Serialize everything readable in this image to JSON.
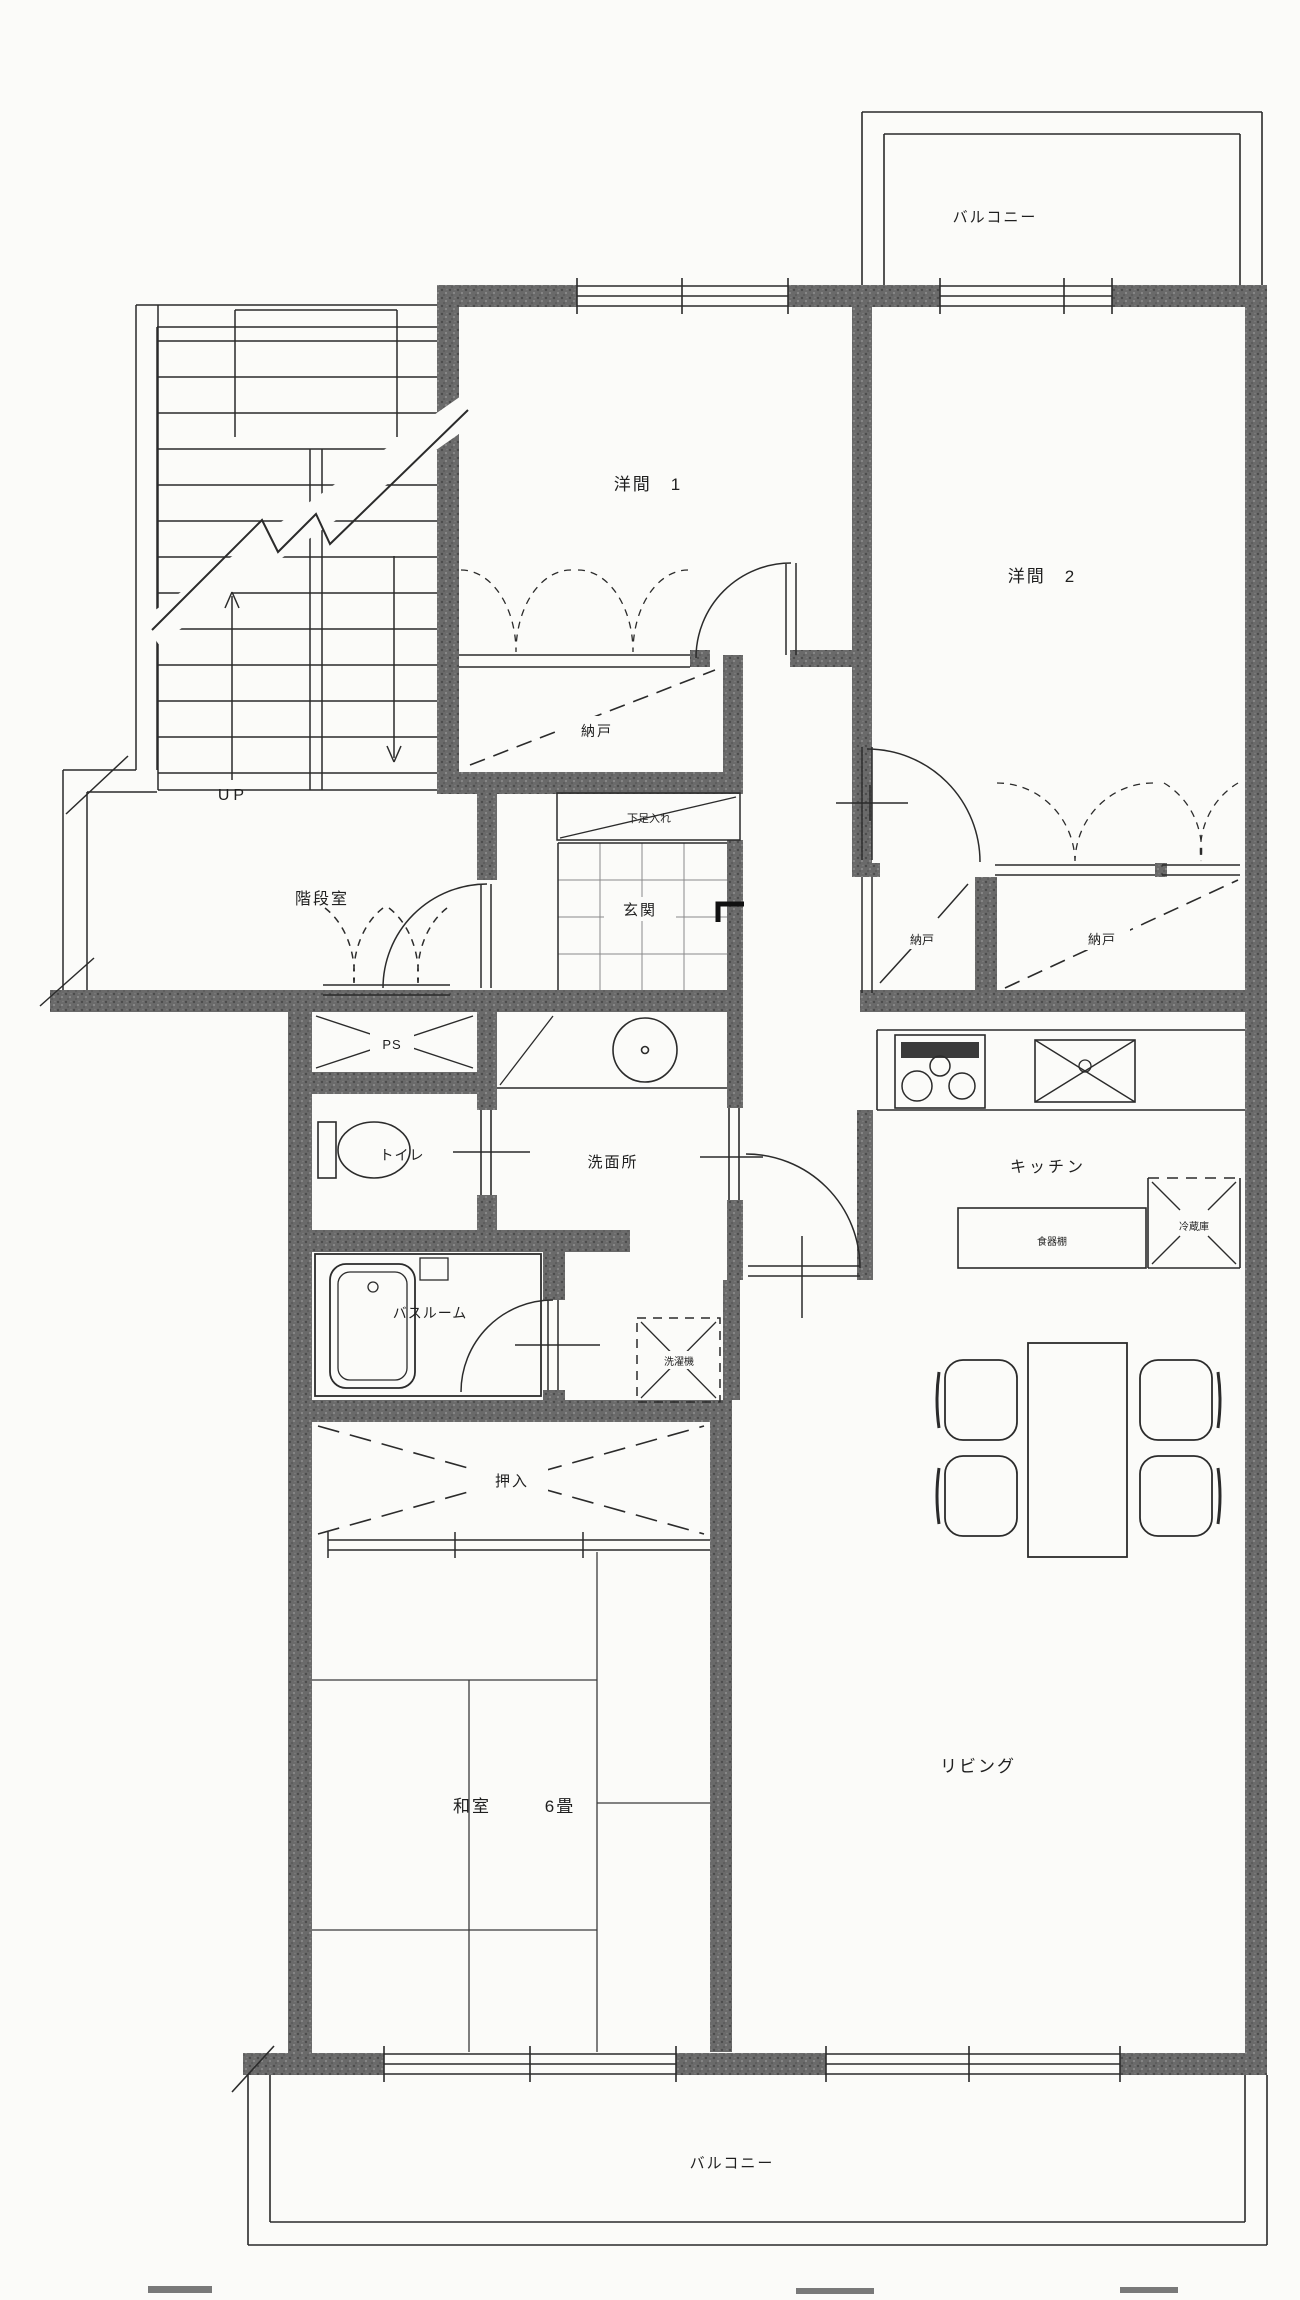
{
  "drawing": {
    "type": "apartment-floor-plan",
    "colors": {
      "paper": "#fbfbf9",
      "line": "#2b2b2b",
      "wall": "#686868",
      "tile": "#8a8a8a"
    }
  },
  "labels": {
    "balcony_top": "バルコニー",
    "balcony_bottom": "バルコニー",
    "western_room_1": "洋間　1",
    "western_room_2": "洋間　2",
    "stair_room": "階段室",
    "up": "UP",
    "storage_a": "納戸",
    "storage_b": "納戸",
    "storage_c": "納戸",
    "shoe_cabinet": "下足入れ",
    "entrance": "玄関",
    "pipe_space": "PS",
    "toilet": "トイレ",
    "washroom": "洗面所",
    "bathroom": "バスルーム",
    "washing_machine": "洗濯機",
    "futon_closet": "押入",
    "japanese_room": "和室",
    "japanese_room_size": "6畳",
    "living": "リビング",
    "kitchen": "キッチン",
    "cupboard": "食器棚",
    "refrigerator": "冷蔵庫"
  }
}
